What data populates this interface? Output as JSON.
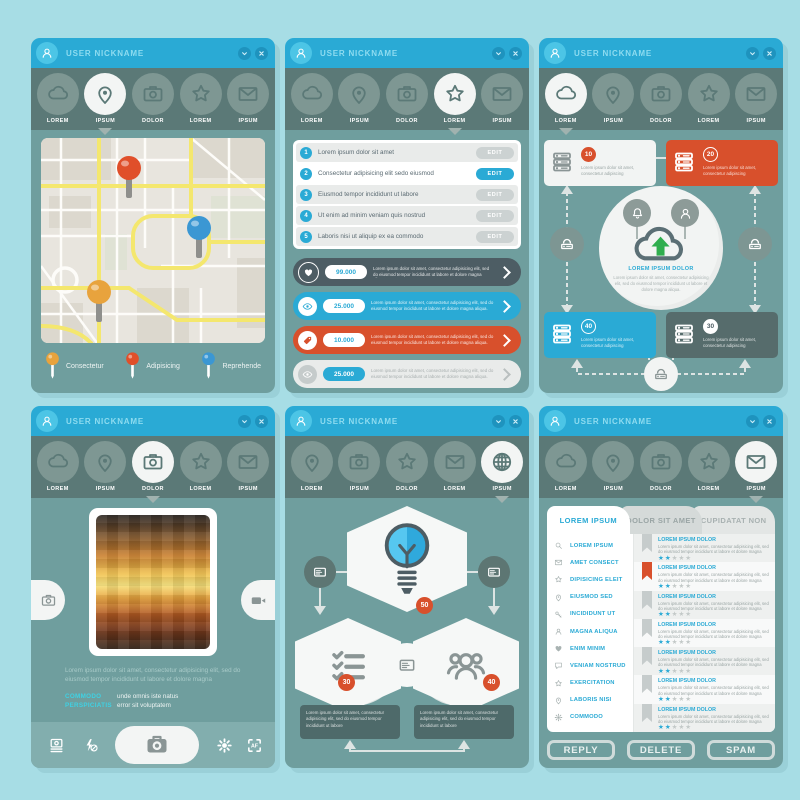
{
  "palette": {
    "background": "#a7dde5",
    "header_blue": "#2aaad5",
    "avatar_blue": "#4cc5e6",
    "navbar_dark": "#5b7977",
    "nav_circle": "#7e9793",
    "panel_body": "#6f9e9e",
    "accent_blue": "#2aaad5",
    "accent_red": "#d8502c",
    "accent_orange": "#e8a33d",
    "pin_blue": "#3b97d3",
    "dark_slate": "#4d5d64",
    "box_dark": "#4e6a6a",
    "toolbar_teal": "#82aeae",
    "green_arrow": "#2fae4e"
  },
  "header": {
    "title": "USER NICKNAME"
  },
  "map_panel": {
    "nav": [
      {
        "icon": "cloud",
        "label": "LOREM"
      },
      {
        "icon": "pin",
        "label": "IPSUM",
        "active": true
      },
      {
        "icon": "camera",
        "label": "DOLOR"
      },
      {
        "icon": "star",
        "label": "LOREM"
      },
      {
        "icon": "mail",
        "label": "IPSUM"
      }
    ],
    "pins": [
      {
        "name": "red-pin",
        "color": "#e04f2a"
      },
      {
        "name": "blue-pin",
        "color": "#3b97d3"
      },
      {
        "name": "orange-pin",
        "color": "#e8a33d"
      }
    ],
    "legend": [
      {
        "color": "#e8a33d",
        "label": "Consectetur"
      },
      {
        "color": "#e04f2a",
        "label": "Adipisicing"
      },
      {
        "color": "#3b97d3",
        "label": "Reprehende"
      }
    ]
  },
  "list_panel": {
    "nav": [
      {
        "icon": "cloud",
        "label": "LOREM"
      },
      {
        "icon": "pin",
        "label": "IPSUM"
      },
      {
        "icon": "camera",
        "label": "DOLOR"
      },
      {
        "icon": "star",
        "label": "LOREM",
        "active": true
      },
      {
        "icon": "mail",
        "label": "IPSUM"
      }
    ],
    "edit_label": "EDIT",
    "items": [
      {
        "num": "1",
        "text": "Lorem ipsum dolor sit amet"
      },
      {
        "num": "2",
        "text": "Consectetur adipisicing elit sedo eiusmod",
        "active": true
      },
      {
        "num": "3",
        "text": "Eiusmod tempor incididunt ut labore"
      },
      {
        "num": "4",
        "text": "Ut enim ad minim veniam quis nostrud"
      },
      {
        "num": "5",
        "text": "Laboris nisi ut aliquip ex ea commodo"
      }
    ],
    "stats": [
      {
        "icon": "heart",
        "value": "99.000",
        "variant": "dark",
        "bg": "#4d5d64",
        "text": "Lorem ipsum dolor sit amet, consectetur adipisicing elit, sed do eiusmod tempor incididunt ut labore et dolore magna aliqua."
      },
      {
        "icon": "eye",
        "value": "25.000",
        "variant": "blue",
        "bg": "#2aaad5",
        "text": "Lorem ipsum dolor sit amet, consectetur adipisicing elit, sed do eiusmod tempor incididunt ut labore et dolore magna aliqua."
      },
      {
        "icon": "tag",
        "value": "10.000",
        "variant": "red",
        "bg": "#d8502c",
        "text": "Lorem ipsum dolor sit amet, consectetur adipisicing elit, sed do eiusmod tempor incididunt ut labore et dolore magna aliqua."
      },
      {
        "icon": "eye",
        "value": "25.000",
        "variant": "light",
        "bg": "#e9ebea",
        "text": "Lorem ipsum dolor sit amet, consectetur adipisicing elit, sed do eiusmod tempor incididunt ut labore et dolore magna aliqua."
      }
    ]
  },
  "network_panel": {
    "nav": [
      {
        "icon": "cloud",
        "label": "LOREM",
        "active": true
      },
      {
        "icon": "pin",
        "label": "IPSUM"
      },
      {
        "icon": "camera",
        "label": "DOLOR"
      },
      {
        "icon": "star",
        "label": "LOREM"
      },
      {
        "icon": "mail",
        "label": "IPSUM"
      }
    ],
    "cards": [
      {
        "value": "10",
        "variant": "white",
        "pos": "tl",
        "text": "Lorem ipsum dolor sit amet, consectetur adipiscing"
      },
      {
        "value": "20",
        "variant": "red",
        "pos": "tr",
        "text": "Lorem ipsum dolor sit amet, consectetur adipiscing"
      },
      {
        "value": "40",
        "variant": "blue",
        "pos": "bl",
        "text": "Lorem ipsum dolor sit amet, consectetur adipiscing"
      },
      {
        "value": "30",
        "variant": "dark",
        "pos": "br",
        "text": "Lorem ipsum dolor sit amet, consectetur adipiscing"
      }
    ],
    "center": {
      "title": "LOREM IPSUM DOLOR",
      "body": "Lorem ipsum dolor sit amet, consectetur adipisicing elit, sed do eiusmod tempor incididunt ut labore et dolore magna aliqua."
    }
  },
  "photo_panel": {
    "nav": [
      {
        "icon": "cloud",
        "label": "LOREM"
      },
      {
        "icon": "pin",
        "label": "IPSUM"
      },
      {
        "icon": "camera",
        "label": "DOLOR",
        "active": true
      },
      {
        "icon": "star",
        "label": "LOREM"
      },
      {
        "icon": "mail",
        "label": "IPSUM"
      }
    ],
    "caption": "Lorem ipsum dolor sit amet, consectetur adipisicing elit, sed do eiusmod tempor incididunt ut labore et dolore magna",
    "meta": [
      {
        "label": "COMMODO",
        "text": "unde omnis iste natus"
      },
      {
        "label": "PERSPICIATIS",
        "text": "error sit voluptatem"
      }
    ]
  },
  "hex_panel": {
    "nav": [
      {
        "icon": "pin",
        "label": "LOREM"
      },
      {
        "icon": "camera",
        "label": "IPSUM"
      },
      {
        "icon": "star",
        "label": "DOLOR"
      },
      {
        "icon": "mail",
        "label": "LOREM"
      },
      {
        "icon": "globe",
        "label": "IPSUM",
        "active": true
      }
    ],
    "badges": {
      "top": "50",
      "left": "30",
      "right": "40"
    },
    "boxes": [
      {
        "text": "Lorem ipsum dolor sit amet, consectetur adipisicing elit, sed do eiusmod tempor incididunt ut labore"
      },
      {
        "text": "Lorem ipsum dolor sit amet, consectetur adipisicing elit, sed do eiusmod tempor incididunt ut labore"
      }
    ]
  },
  "mail_panel": {
    "nav": [
      {
        "icon": "cloud",
        "label": "LOREM"
      },
      {
        "icon": "pin",
        "label": "IPSUM"
      },
      {
        "icon": "camera",
        "label": "DOLOR"
      },
      {
        "icon": "star",
        "label": "LOREM"
      },
      {
        "icon": "mail",
        "label": "IPSUM",
        "active": true
      }
    ],
    "tabs": [
      {
        "label": "LOREM IPSUM",
        "active": true
      },
      {
        "label": "DOLOR SIT AMET"
      },
      {
        "label": "CUPIDATAT NON"
      }
    ],
    "menu": [
      {
        "icon": "search",
        "label": "LOREM IPSUM"
      },
      {
        "icon": "mail",
        "label": "AMET CONSECT"
      },
      {
        "icon": "star",
        "label": "DIPISICING ELEIT"
      },
      {
        "icon": "pin",
        "label": "EIUSMOD SED"
      },
      {
        "icon": "key",
        "label": "INCIDIDUNT UT"
      },
      {
        "icon": "person",
        "label": "MAGNA ALIQUA"
      },
      {
        "icon": "heart",
        "label": "ENIM MINIM"
      },
      {
        "icon": "chat",
        "label": "VENIAM NOSTRUD"
      },
      {
        "icon": "star",
        "label": "EXERCITATION"
      },
      {
        "icon": "pin",
        "label": "LABORIS NISI"
      },
      {
        "icon": "gear",
        "label": "COMMODO"
      }
    ],
    "entries": [
      {
        "title": "LOREM IPSUM DOLOR",
        "body": "Lorem ipsum dolor sit amet, consectetur adipisicing elit, sed do eiusmod tempor incididunt ut labore et dolore magna aliqua.",
        "bookmark": "#c6cccc",
        "rating": "2",
        "stars_on": "★★",
        "stars_off": "★★★"
      },
      {
        "title": "LOREM IPSUM DOLOR",
        "body": "Lorem ipsum dolor sit amet, consectetur adipisicing elit, sed do eiusmod tempor incididunt ut labore et dolore magna aliqua.",
        "bookmark": "#d8502c",
        "rating": "2",
        "stars_on": "★★",
        "stars_off": "★★★"
      },
      {
        "title": "LOREM IPSUM DOLOR",
        "body": "Lorem ipsum dolor sit amet, consectetur adipisicing elit, sed do eiusmod tempor incididunt ut labore et dolore magna aliqua.",
        "bookmark": "#c6cccc",
        "rating": "2",
        "stars_on": "★★",
        "stars_off": "★★★"
      },
      {
        "title": "LOREM IPSUM DOLOR",
        "body": "Lorem ipsum dolor sit amet, consectetur adipisicing elit, sed do eiusmod tempor incididunt ut labore et dolore magna aliqua.",
        "bookmark": "#c6cccc",
        "rating": "2",
        "stars_on": "★★",
        "stars_off": "★★★"
      },
      {
        "title": "LOREM IPSUM DOLOR",
        "body": "Lorem ipsum dolor sit amet, consectetur adipisicing elit, sed do eiusmod tempor incididunt ut labore et dolore magna aliqua.",
        "bookmark": "#c6cccc",
        "rating": "2",
        "stars_on": "★★",
        "stars_off": "★★★"
      },
      {
        "title": "LOREM IPSUM DOLOR",
        "body": "Lorem ipsum dolor sit amet, consectetur adipisicing elit, sed do eiusmod tempor incididunt ut labore et dolore magna aliqua.",
        "bookmark": "#c6cccc",
        "rating": "2",
        "stars_on": "★★",
        "stars_off": "★★★"
      },
      {
        "title": "LOREM IPSUM DOLOR",
        "body": "Lorem ipsum dolor sit amet, consectetur adipisicing elit, sed do eiusmod tempor incididunt ut labore et dolore magna aliqua.",
        "bookmark": "#c6cccc",
        "rating": "2",
        "stars_on": "★★",
        "stars_off": "★★★"
      }
    ],
    "buttons": [
      {
        "label": "REPLY"
      },
      {
        "label": "DELETE"
      },
      {
        "label": "SPAM"
      }
    ]
  }
}
